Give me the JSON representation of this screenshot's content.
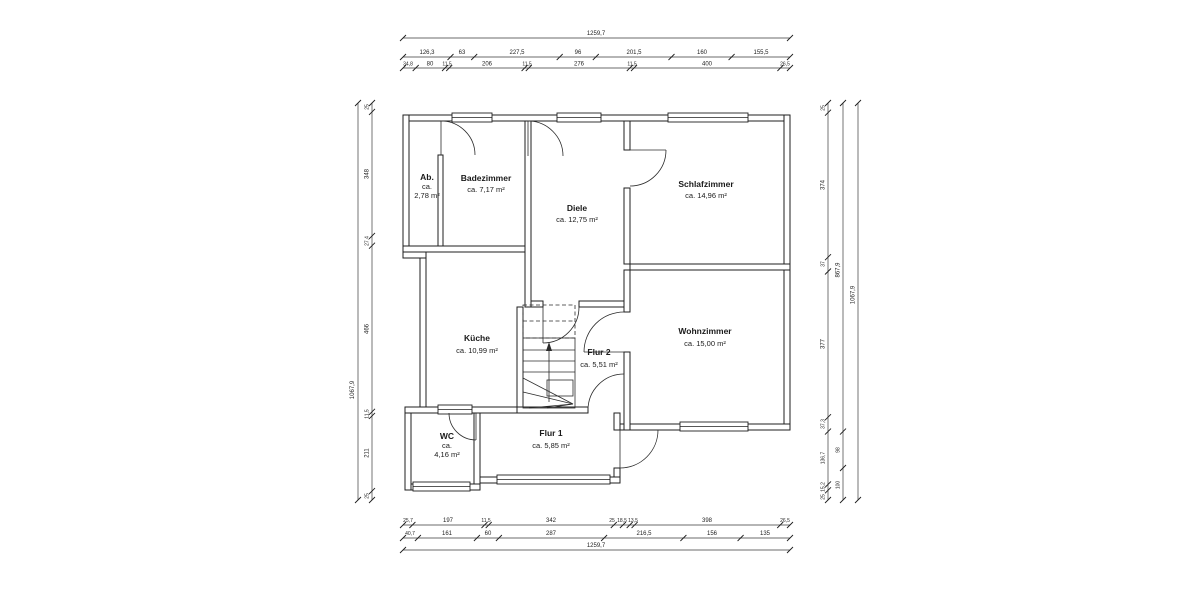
{
  "canvas": {
    "background": "#ffffff",
    "line_color": "#1f1f1f"
  },
  "rooms": {
    "ab": {
      "name": "Ab.",
      "l2": "ca.",
      "l3": "2,78 m²"
    },
    "badezimmer": {
      "name": "Badezimmer",
      "area": "ca. 7,17 m²"
    },
    "diele": {
      "name": "Diele",
      "area": "ca. 12,75 m²"
    },
    "schlafzimmer": {
      "name": "Schlafzimmer",
      "area": "ca. 14,96 m²"
    },
    "kueche": {
      "name": "Küche",
      "area": "ca. 10,99 m²"
    },
    "flur2": {
      "name": "Flur 2",
      "area": "ca. 5,51 m²"
    },
    "wohnzimmer": {
      "name": "Wohnzimmer",
      "area": "ca. 15,00 m²"
    },
    "wc": {
      "name": "WC",
      "l2": "ca.",
      "l3": "4,16 m²"
    },
    "flur1": {
      "name": "Flur 1",
      "area": "ca. 5,85 m²"
    }
  },
  "dimensions": {
    "top": {
      "total": "1259,7",
      "row2": [
        "126,3",
        "63",
        "227,5",
        "96",
        "201,5",
        "160",
        "155,5"
      ],
      "row3": [
        "34,8",
        "80",
        "11,5",
        "206",
        "11,5",
        "276",
        "11,5",
        "400",
        "26,5"
      ]
    },
    "bottom": {
      "row1": [
        "25,7",
        "197",
        "11,5",
        "342",
        "25",
        "18,5",
        "13,5",
        "398",
        "26,5"
      ],
      "row2": [
        "40,7",
        "161",
        "60",
        "287",
        "216,5",
        "156",
        "135"
      ],
      "total": "1259,7"
    },
    "left": {
      "total": "1067,9",
      "segments": [
        "25",
        "348",
        "27,4",
        "466",
        "11,5",
        "211",
        "25"
      ]
    },
    "right": {
      "segments": [
        "25",
        "374",
        "37",
        "377",
        "37,3",
        "136,7",
        "15,2",
        "25"
      ],
      "middle_total": "867,9",
      "middle_segments": [
        "98",
        "100"
      ],
      "total": "1067,9"
    }
  }
}
